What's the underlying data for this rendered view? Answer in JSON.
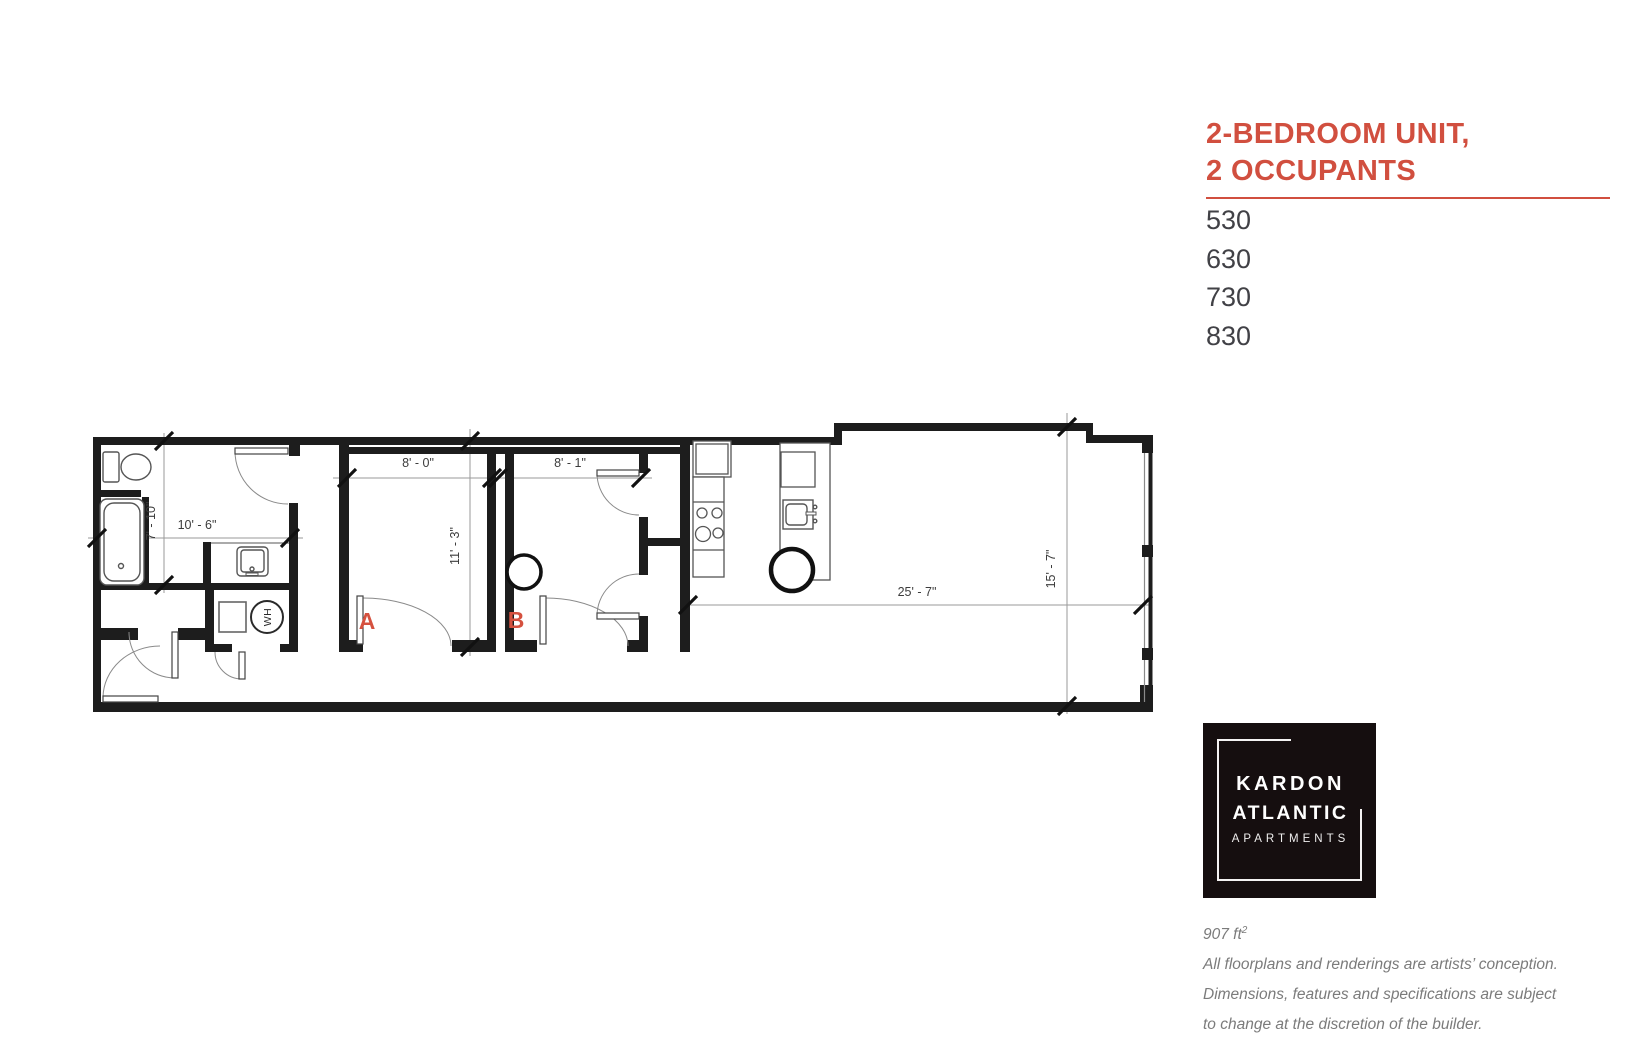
{
  "title": {
    "line1": "2-BEDROOM UNIT,",
    "line2": "2 OCCUPANTS"
  },
  "units": [
    "530",
    "630",
    "730",
    "830"
  ],
  "floorplan": {
    "rooms": {
      "bedroom_a": "A",
      "bedroom_b": "B",
      "water_heater": "WH"
    },
    "dims": {
      "bath_width": "10' - 6\"",
      "bath_depth": "7' - 10\"",
      "bedroom_a_width": "8' - 0\"",
      "bedroom_a_depth": "11' - 3\"",
      "bedroom_b_width": "8' - 1\"",
      "living_width": "25' - 7\"",
      "living_depth": "15' - 7\""
    }
  },
  "logo": {
    "line1": "KARDON",
    "line2": "ATLANTIC",
    "line3": "APARTMENTS"
  },
  "footer": {
    "area": "907 ft",
    "area_sup": "2",
    "line1": "All floorplans and renderings are artists’ conception.",
    "line2": "Dimensions, features and specifications are subject",
    "line3": "to change at the discretion of the builder."
  },
  "colors": {
    "accent": "#d14f3f",
    "room_label": "#d5513f",
    "wall": "#1d1d1d",
    "dim_line": "#9a9a9a",
    "dim_text": "#3c3c3c",
    "logo_bg": "#150e0f",
    "footer_text": "#7b7b7b",
    "unit_text": "#414146"
  }
}
